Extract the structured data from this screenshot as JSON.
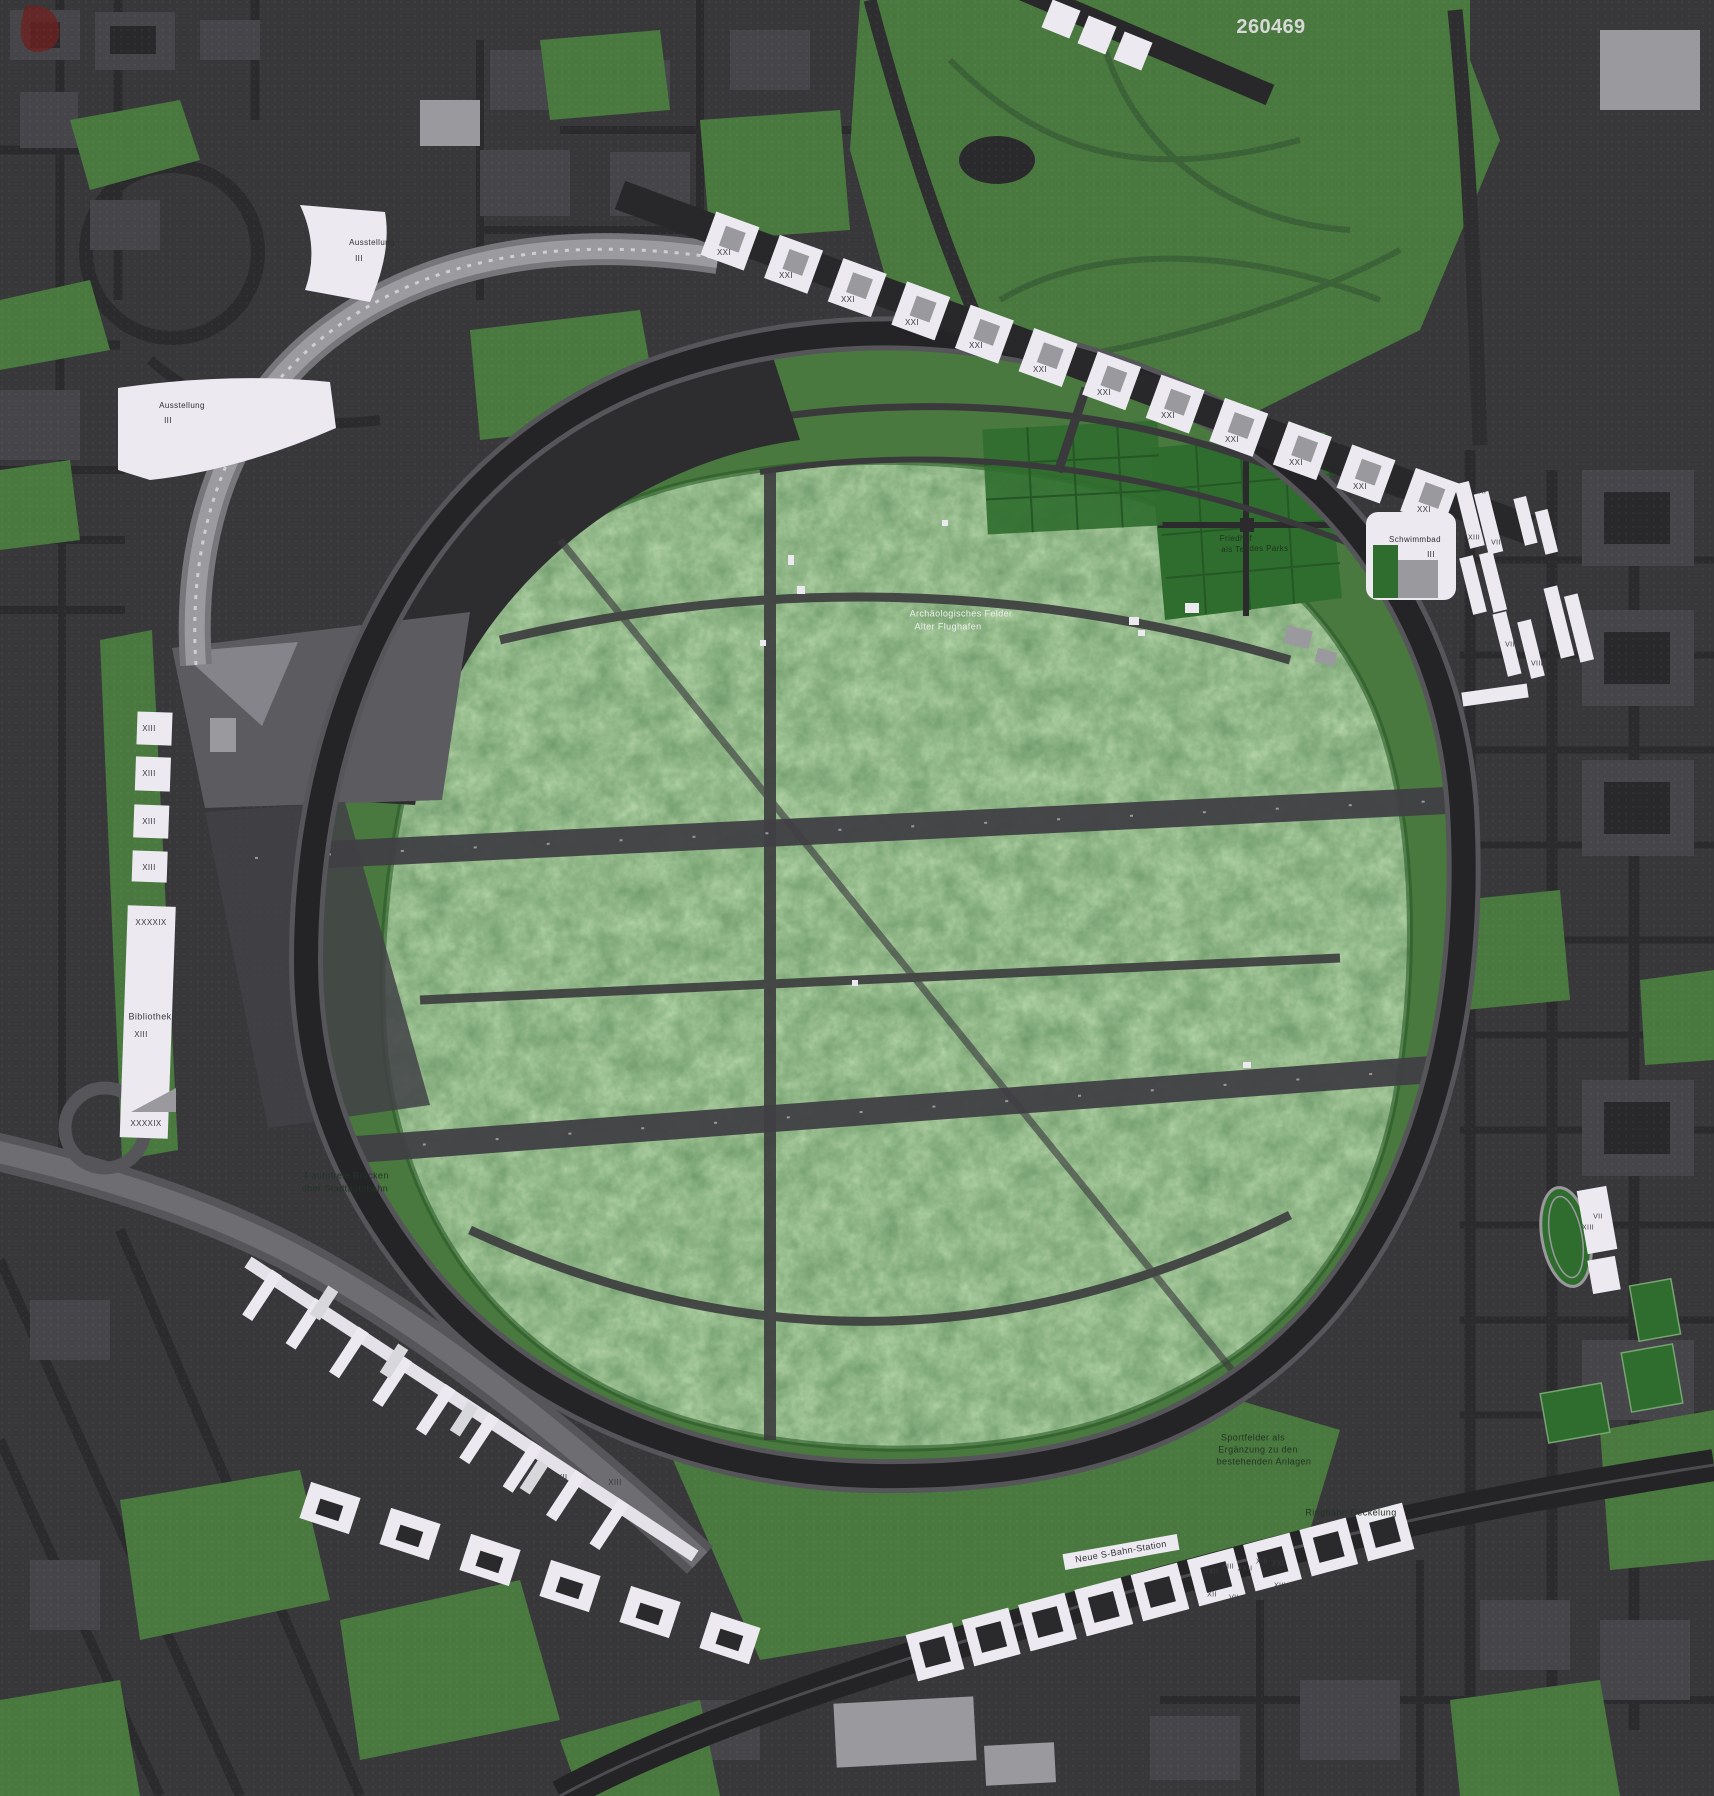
{
  "map": {
    "competition_number": "260469",
    "palette": {
      "background": "#38383b",
      "road_dark": "#2b2b2d",
      "ring_road": "#242427",
      "city_block": "#46464a",
      "building_dark": "#29292c",
      "building_gray": "#9a9a9e",
      "building_white": "#eceaf0",
      "green": "#49793f",
      "green_dark": "#2f6d2e",
      "forest_mid": "#4a8040",
      "highway_gray": "#58585d",
      "apron_dark": "#2d2d30",
      "apron_gray": "#5b5b60",
      "text_light": "#f0f0f0",
      "text_dark": "#2e2e32"
    },
    "labels": [
      {
        "text": "260469",
        "x": 1271,
        "y": 27,
        "size": 20,
        "color": "#d8d8d8",
        "bold": true,
        "name": "competition-number"
      },
      {
        "text": "Ausstellung",
        "x": 372,
        "y": 243,
        "size": 8,
        "color": "#2e2e32",
        "name": "label-ausstellung-1"
      },
      {
        "text": "III",
        "x": 359,
        "y": 259,
        "size": 8,
        "color": "#2e2e32"
      },
      {
        "text": "Ausstellung",
        "x": 182,
        "y": 406,
        "size": 8,
        "color": "#2e2e32",
        "name": "label-ausstellung-2"
      },
      {
        "text": "III",
        "x": 168,
        "y": 421,
        "size": 8,
        "color": "#2e2e32"
      },
      {
        "text": "XIII",
        "x": 149,
        "y": 729,
        "size": 8,
        "color": "#3a3a3e"
      },
      {
        "text": "XIII",
        "x": 149,
        "y": 774,
        "size": 8,
        "color": "#3a3a3e"
      },
      {
        "text": "XIII",
        "x": 149,
        "y": 822,
        "size": 8,
        "color": "#3a3a3e"
      },
      {
        "text": "XIII",
        "x": 149,
        "y": 868,
        "size": 8,
        "color": "#3a3a3e"
      },
      {
        "text": "XXXXIX",
        "x": 151,
        "y": 923,
        "size": 8,
        "color": "#3a3a3e"
      },
      {
        "text": "Bibliothek",
        "x": 150,
        "y": 1017,
        "size": 9,
        "color": "#3a3a3e",
        "name": "label-bibliothek"
      },
      {
        "text": "XIII",
        "x": 141,
        "y": 1035,
        "size": 8,
        "color": "#3a3a3e"
      },
      {
        "text": "XXXXIX",
        "x": 146,
        "y": 1124,
        "size": 8,
        "color": "#3a3a3e"
      },
      {
        "text": "Archäologisches Felder",
        "x": 961,
        "y": 614,
        "size": 9,
        "color": "#f0f0f0",
        "name": "label-archaeologisches-felder"
      },
      {
        "text": "Alter Flughafen",
        "x": 948,
        "y": 627,
        "size": 9,
        "color": "#f0f0f0"
      },
      {
        "text": "Friedhof",
        "x": 1236,
        "y": 539,
        "size": 8,
        "color": "#1e3320",
        "name": "label-friedhof"
      },
      {
        "text": "als Teil",
        "x": 1235,
        "y": 550,
        "size": 8,
        "color": "#1e3320"
      },
      {
        "text": "des Parks",
        "x": 1269,
        "y": 549,
        "size": 8,
        "color": "#1e3320"
      },
      {
        "text": "Schwimmbad",
        "x": 1415,
        "y": 540,
        "size": 8,
        "color": "#2e2e32",
        "name": "label-schwimmbad"
      },
      {
        "text": "III",
        "x": 1431,
        "y": 555,
        "size": 8,
        "color": "#2e2e32"
      },
      {
        "text": "XXI",
        "x": 724,
        "y": 253,
        "size": 8,
        "color": "#3a3a3e"
      },
      {
        "text": "XXI",
        "x": 786,
        "y": 276,
        "size": 8,
        "color": "#3a3a3e"
      },
      {
        "text": "XXI",
        "x": 848,
        "y": 300,
        "size": 8,
        "color": "#3a3a3e"
      },
      {
        "text": "XXI",
        "x": 912,
        "y": 323,
        "size": 8,
        "color": "#3a3a3e"
      },
      {
        "text": "XXI",
        "x": 976,
        "y": 346,
        "size": 8,
        "color": "#3a3a3e"
      },
      {
        "text": "XXI",
        "x": 1040,
        "y": 370,
        "size": 8,
        "color": "#3a3a3e"
      },
      {
        "text": "XXI",
        "x": 1104,
        "y": 393,
        "size": 8,
        "color": "#3a3a3e"
      },
      {
        "text": "XXI",
        "x": 1168,
        "y": 416,
        "size": 8,
        "color": "#3a3a3e"
      },
      {
        "text": "XXI",
        "x": 1232,
        "y": 440,
        "size": 8,
        "color": "#3a3a3e"
      },
      {
        "text": "XXI",
        "x": 1296,
        "y": 463,
        "size": 8,
        "color": "#3a3a3e"
      },
      {
        "text": "XXI",
        "x": 1360,
        "y": 487,
        "size": 8,
        "color": "#3a3a3e"
      },
      {
        "text": "XXI",
        "x": 1424,
        "y": 510,
        "size": 8,
        "color": "#3a3a3e"
      },
      {
        "text": "XXI",
        "x": 1480,
        "y": 492,
        "size": 7,
        "color": "#3a3a3e"
      },
      {
        "text": "XIII",
        "x": 1474,
        "y": 538,
        "size": 7,
        "color": "#3a3a3e"
      },
      {
        "text": "VII",
        "x": 1496,
        "y": 543,
        "size": 7,
        "color": "#3a3a3e"
      },
      {
        "text": "VII",
        "x": 1529,
        "y": 601,
        "size": 7,
        "color": "#3a3a3e"
      },
      {
        "text": "VII",
        "x": 1510,
        "y": 645,
        "size": 7,
        "color": "#3a3a3e"
      },
      {
        "text": "XIII",
        "x": 1496,
        "y": 664,
        "size": 7,
        "color": "#3a3a3e"
      },
      {
        "text": "VIII",
        "x": 1537,
        "y": 664,
        "size": 7,
        "color": "#3a3a3e"
      },
      {
        "text": "VII",
        "x": 562,
        "y": 1478,
        "size": 8,
        "color": "#3a3a3e"
      },
      {
        "text": "XIII",
        "x": 615,
        "y": 1483,
        "size": 8,
        "color": "#3a3a3e"
      },
      {
        "text": "VII",
        "x": 568,
        "y": 1517,
        "size": 8,
        "color": "#3a3a3e"
      },
      {
        "text": "Neue S-Bahn-Station",
        "x": 1121,
        "y": 1552,
        "size": 9,
        "color": "#2e2e32",
        "angle": -10,
        "name": "label-neue-sbahn-station"
      },
      {
        "text": "XXII",
        "x": 1211,
        "y": 1572,
        "size": 7,
        "color": "#3a3a3e"
      },
      {
        "text": "XIII",
        "x": 1228,
        "y": 1567,
        "size": 7,
        "color": "#3a3a3e"
      },
      {
        "text": "XXII",
        "x": 1245,
        "y": 1569,
        "size": 7,
        "color": "#3a3a3e"
      },
      {
        "text": "XIII",
        "x": 1262,
        "y": 1562,
        "size": 7,
        "color": "#3a3a3e"
      },
      {
        "text": "XXI",
        "x": 1278,
        "y": 1564,
        "size": 7,
        "color": "#3a3a3e"
      },
      {
        "text": "XIII",
        "x": 1280,
        "y": 1586,
        "size": 7,
        "color": "#3a3a3e"
      },
      {
        "text": "XII",
        "x": 1212,
        "y": 1595,
        "size": 7,
        "color": "#3a3a3e"
      },
      {
        "text": "VII",
        "x": 1234,
        "y": 1598,
        "size": 7,
        "color": "#3a3a3e"
      },
      {
        "text": "VII",
        "x": 1268,
        "y": 1593,
        "size": 7,
        "color": "#3a3a3e"
      },
      {
        "text": "Sportfelder als",
        "x": 1253,
        "y": 1438,
        "size": 9,
        "color": "#233423",
        "name": "label-sportfelder"
      },
      {
        "text": "Ergänzung zu den",
        "x": 1258,
        "y": 1450,
        "size": 9,
        "color": "#233423"
      },
      {
        "text": "bestehenden Anlagen",
        "x": 1264,
        "y": 1462,
        "size": 9,
        "color": "#233423"
      },
      {
        "text": "Ringbahn-Deckelung",
        "x": 1351,
        "y": 1513,
        "size": 9,
        "color": "#233423",
        "name": "label-ringbahn-deckelung"
      },
      {
        "text": "4 autofreie Brücken",
        "x": 346,
        "y": 1176,
        "size": 9,
        "color": "#233423",
        "name": "label-autofreie-bruecken"
      },
      {
        "text": "über Stadtautobahn",
        "x": 345,
        "y": 1189,
        "size": 9,
        "color": "#233423"
      },
      {
        "text": "VII",
        "x": 1598,
        "y": 1217,
        "size": 7,
        "color": "#3a3a3e"
      },
      {
        "text": "XIII",
        "x": 1588,
        "y": 1228,
        "size": 7,
        "color": "#3a3a3e"
      }
    ]
  }
}
